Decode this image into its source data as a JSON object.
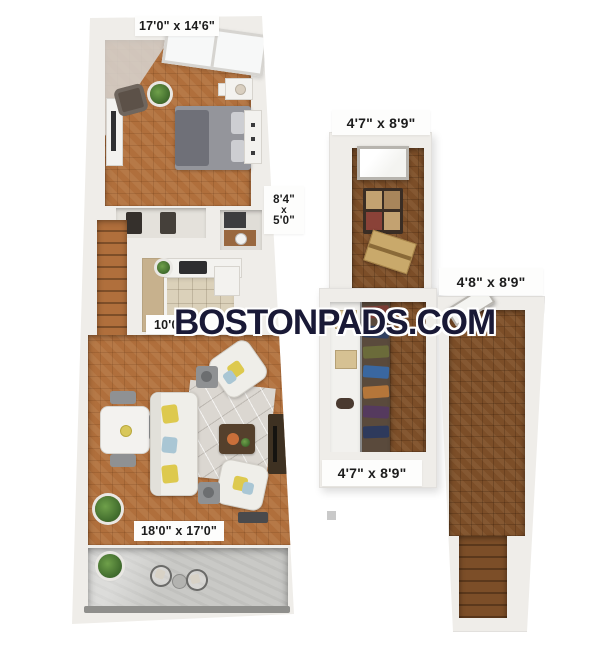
{
  "document": {
    "type": "floor-plan",
    "watermark": "BOSTONPADS.COM"
  },
  "dimension_labels": {
    "bedroom": "17'0\" x 14'6\"",
    "hall_width": "8'4\"",
    "hall_times": "x",
    "hall_depth": "5'0\"",
    "kitchen": "10'0\"",
    "living_room": "18'0\" x 17'0\"",
    "right_top_room": "4'7\" x 8'9\"",
    "right_side_hall": "4'8\" x 8'9\"",
    "closet_room": "4'7\" x 8'9\""
  },
  "colors": {
    "watermark_text": "#191936",
    "light_wood_floor": "#b06f3c",
    "dark_wood_floor": "#7c4e28",
    "kitchen_tile": "#dbd1ba",
    "balcony_concrete": "#c9c9c6",
    "walls": "#efede9",
    "label_text": "#1c1c1c",
    "label_background": "#fdfdfc"
  }
}
